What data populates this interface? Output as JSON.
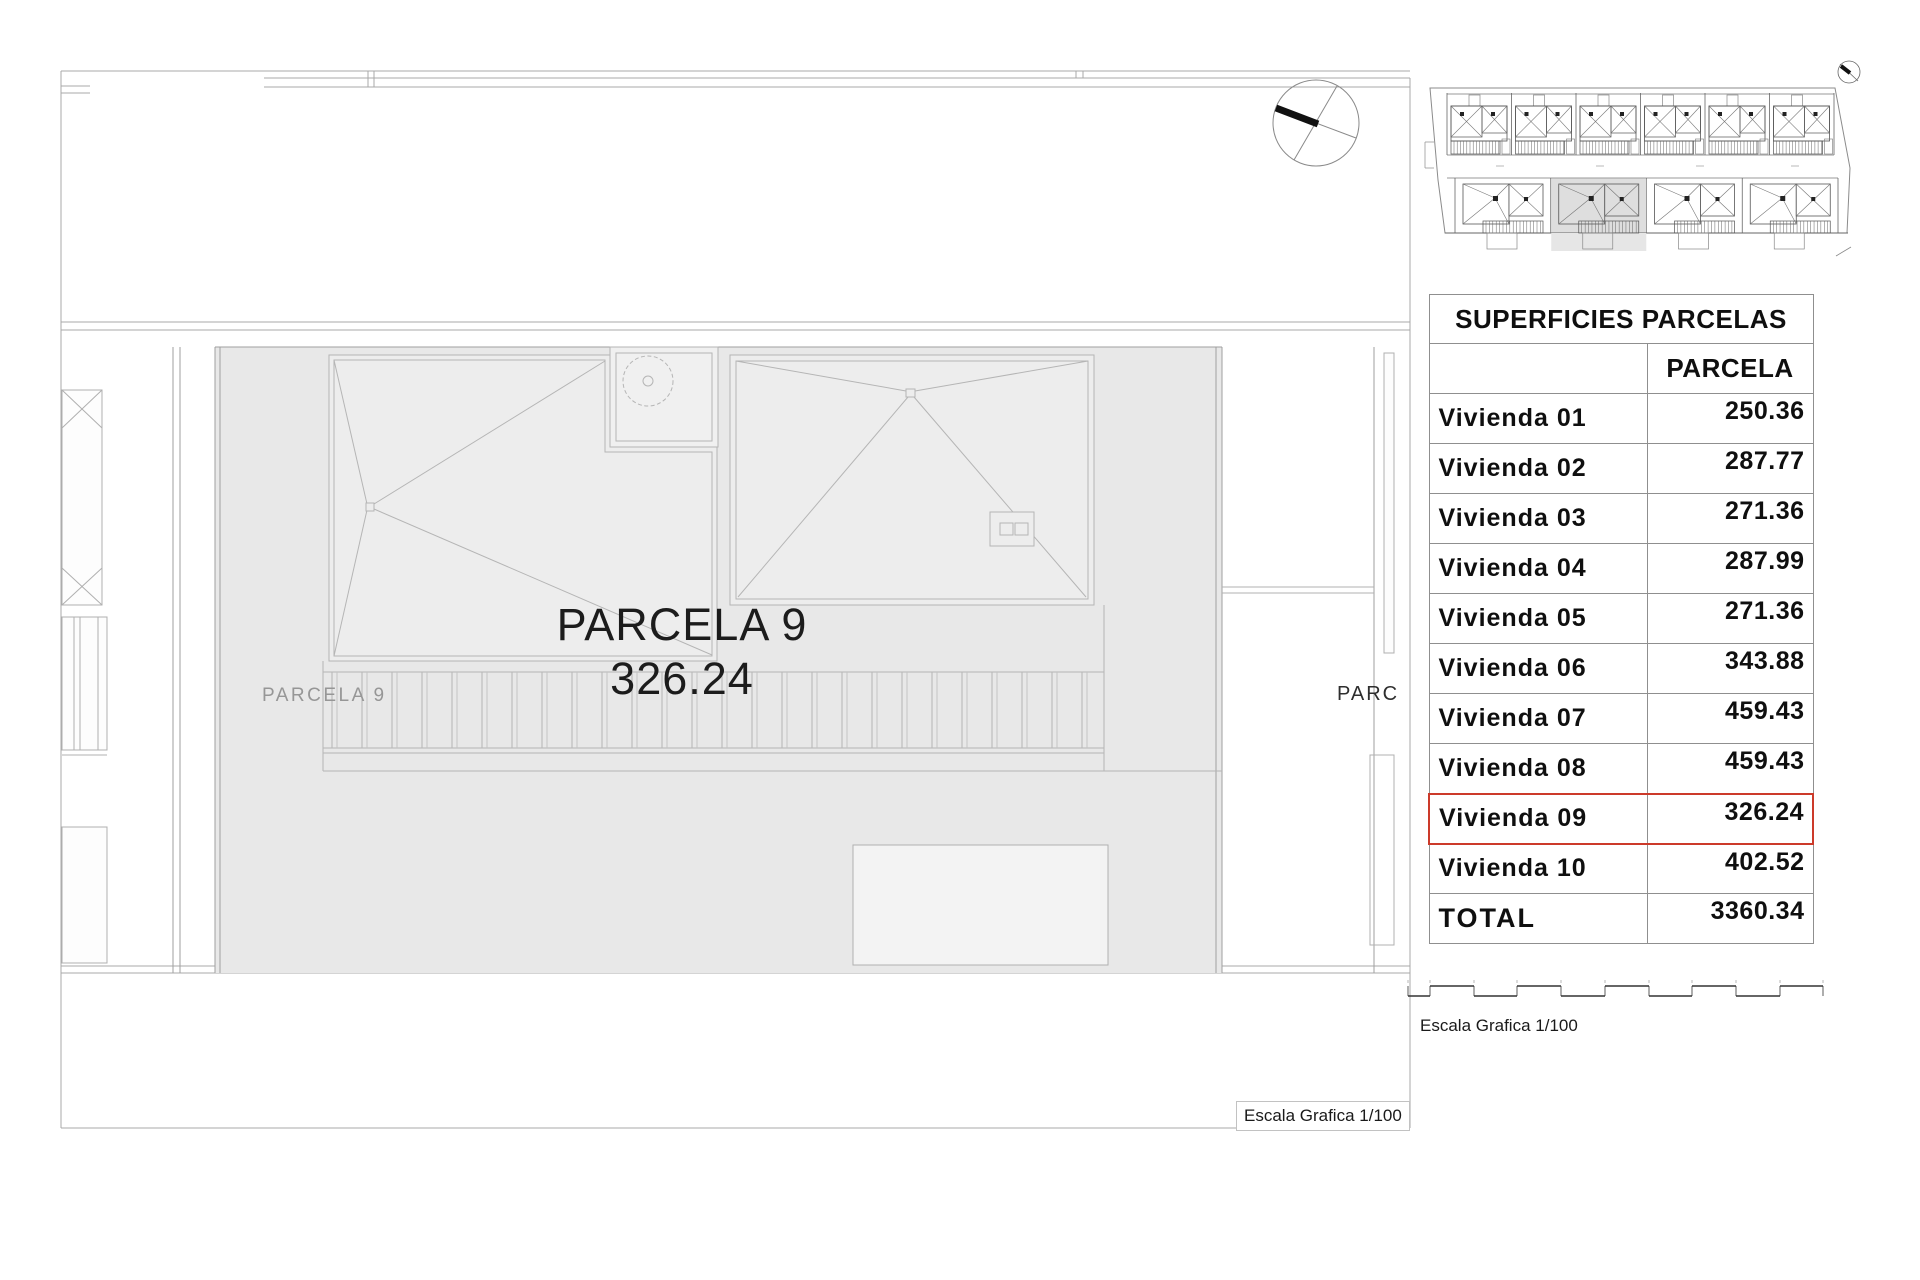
{
  "sheet": {
    "main_plan": {
      "parcel_title": "PARCELA 9",
      "parcel_area": "326.24",
      "parcel_ground_label": "PARCELA 9",
      "neighbor_parcel_label_clipped": "PARC",
      "scale_caption": "Escala Grafica 1/100"
    },
    "areas_table": {
      "title": "SUPERFICIES PARCELAS",
      "value_column_header": "PARCELA",
      "highlight_color": "#cc3a2a",
      "highlight_row_label": "Vivienda 09",
      "rows": [
        {
          "label": "Vivienda 01",
          "value": "250.36",
          "highlight": false,
          "total": false
        },
        {
          "label": "Vivienda 02",
          "value": "287.77",
          "highlight": false,
          "total": false
        },
        {
          "label": "Vivienda 03",
          "value": "271.36",
          "highlight": false,
          "total": false
        },
        {
          "label": "Vivienda 04",
          "value": "287.99",
          "highlight": false,
          "total": false
        },
        {
          "label": "Vivienda 05",
          "value": "271.36",
          "highlight": false,
          "total": false
        },
        {
          "label": "Vivienda 06",
          "value": "343.88",
          "highlight": false,
          "total": false
        },
        {
          "label": "Vivienda 07",
          "value": "459.43",
          "highlight": false,
          "total": false
        },
        {
          "label": "Vivienda 08",
          "value": "459.43",
          "highlight": false,
          "total": false
        },
        {
          "label": "Vivienda 09",
          "value": "326.24",
          "highlight": true,
          "total": false
        },
        {
          "label": "Vivienda 10",
          "value": "402.52",
          "highlight": false,
          "total": false
        },
        {
          "label": "TOTAL",
          "value": "3360.34",
          "highlight": false,
          "total": true
        }
      ]
    },
    "scale_bar_caption": "Escala Grafica 1/100"
  },
  "chart_data": {
    "type": "table",
    "title": "SUPERFICIES PARCELAS",
    "columns": [
      "",
      "PARCELA"
    ],
    "rows": [
      [
        "Vivienda 01",
        250.36
      ],
      [
        "Vivienda 02",
        287.77
      ],
      [
        "Vivienda 03",
        271.36
      ],
      [
        "Vivienda 04",
        287.99
      ],
      [
        "Vivienda 05",
        271.36
      ],
      [
        "Vivienda 06",
        343.88
      ],
      [
        "Vivienda 07",
        459.43
      ],
      [
        "Vivienda 08",
        459.43
      ],
      [
        "Vivienda 09",
        326.24
      ],
      [
        "Vivienda 10",
        402.52
      ],
      [
        "TOTAL",
        3360.34
      ]
    ]
  }
}
